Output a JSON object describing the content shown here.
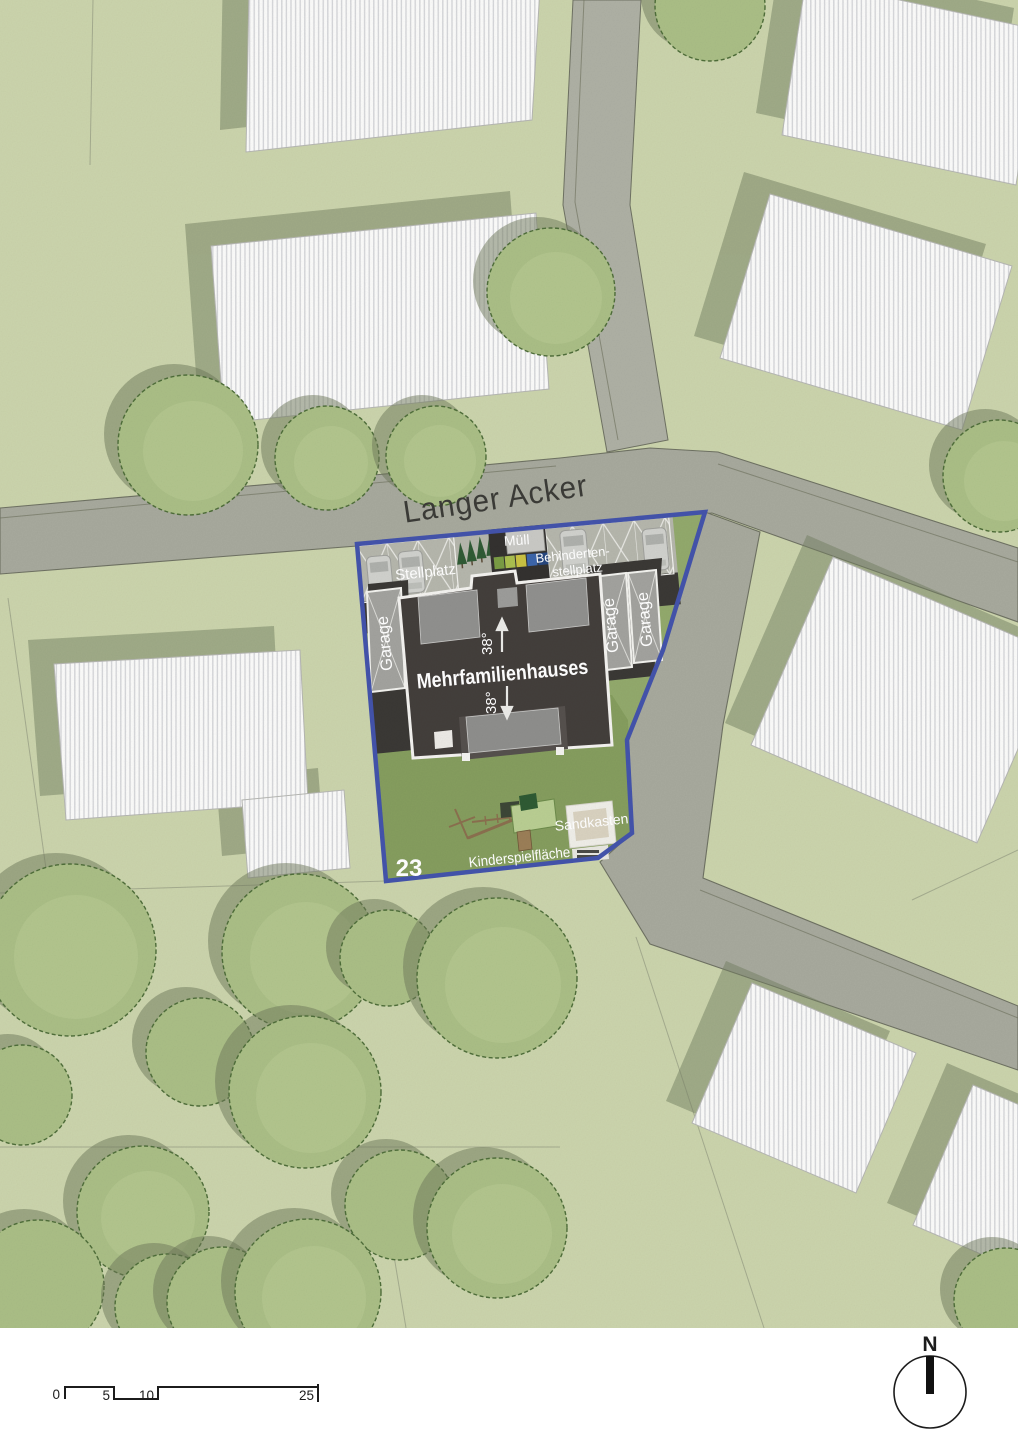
{
  "map": {
    "street_label": "Langer Acker",
    "plot": {
      "number": "23",
      "building_label": "Mehrfamilienhauses",
      "roof_pitch": "38°",
      "parking_label": "Stellplatz",
      "waste_label": "Müll",
      "accessible_line1": "Behinderten-",
      "accessible_line2": "stellplatz",
      "garage_label": "Garage",
      "sandbox_label": "Sandkasten",
      "playground_label": "Kinderspielfläche"
    }
  },
  "scale_bar": {
    "labels": [
      "0",
      "5",
      "10",
      "25"
    ]
  },
  "compass": {
    "north": "N"
  },
  "colors": {
    "plot_boundary": "#4353ab",
    "plot_grass": "#92a96c",
    "garden_grass": "#839b5c",
    "outer_grass": "#cbd4ac",
    "road": "#a7a99d",
    "pavement": "#b5b6ac",
    "asphalt": "#3a3835",
    "main_building": "#433e3b",
    "neighbor_building": "#fbfbfa",
    "tree": "#aabe86",
    "shadow": "#747f61"
  }
}
